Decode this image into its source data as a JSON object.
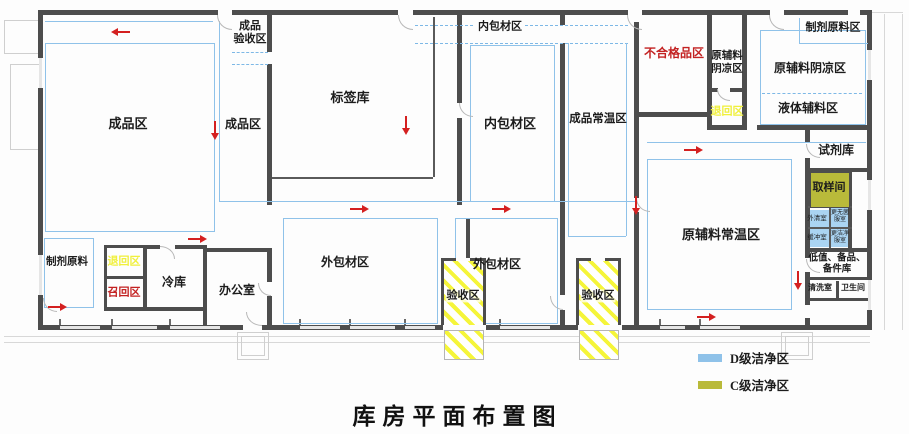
{
  "title": "库房平面布置图",
  "legend": {
    "d": {
      "label": "D级洁净区",
      "color": "#8fc2e9"
    },
    "c": {
      "label": "C级洁净区",
      "color": "#b9ba3a"
    }
  },
  "rooms": {
    "finished_goods_main": "成品区",
    "finished_goods_acceptance": "成品\n验收区",
    "finished_goods_narrow": "成品区",
    "label_warehouse": "标签库",
    "inner_packaging_corridor": "内包材区",
    "inner_packaging": "内包材区",
    "finished_goods_ambient": "成品常温区",
    "nonconforming_area": "不合格品区",
    "raw_aux_cool_small": "原辅料\n阴凉区",
    "return_area_upper": "退回区",
    "prep_raw_material_area": "制剂原料区",
    "raw_aux_cool_large": "原辅料阴凉区",
    "liquid_excipient_area": "液体辅料区",
    "reagent_warehouse": "试剂库",
    "sampling_room": "取样间",
    "outer_cleaning_room": "外清室",
    "buffer_room": "缓冲室",
    "gowning_room_upper": "更无菌\n服室",
    "gowning_room_lower": "更洁净\n服室",
    "low_value_spares": "低值、备品、\n备件库",
    "washing_room": "清洗室",
    "toilet": "卫生间",
    "raw_aux_ambient": "原辅料常温区",
    "outer_packaging_left": "外包材区",
    "outer_packaging_right": "外包材区",
    "acceptance_left": "验收区",
    "acceptance_right": "验收区",
    "prep_raw_material": "制剂原料",
    "return_area_lower": "退回区",
    "recall_area": "召回区",
    "cold_storage": "冷库",
    "office": "办公室"
  },
  "colors": {
    "wall": "#4d4d4d",
    "clean_d_blue": "#8fc2e9",
    "clean_c_olive": "#b9ba3a",
    "highlight_red": "#c32222",
    "highlight_yellow": "#f0f03c",
    "arrow_red": "#d42020",
    "hatch_yellow": "#f5f53a"
  }
}
